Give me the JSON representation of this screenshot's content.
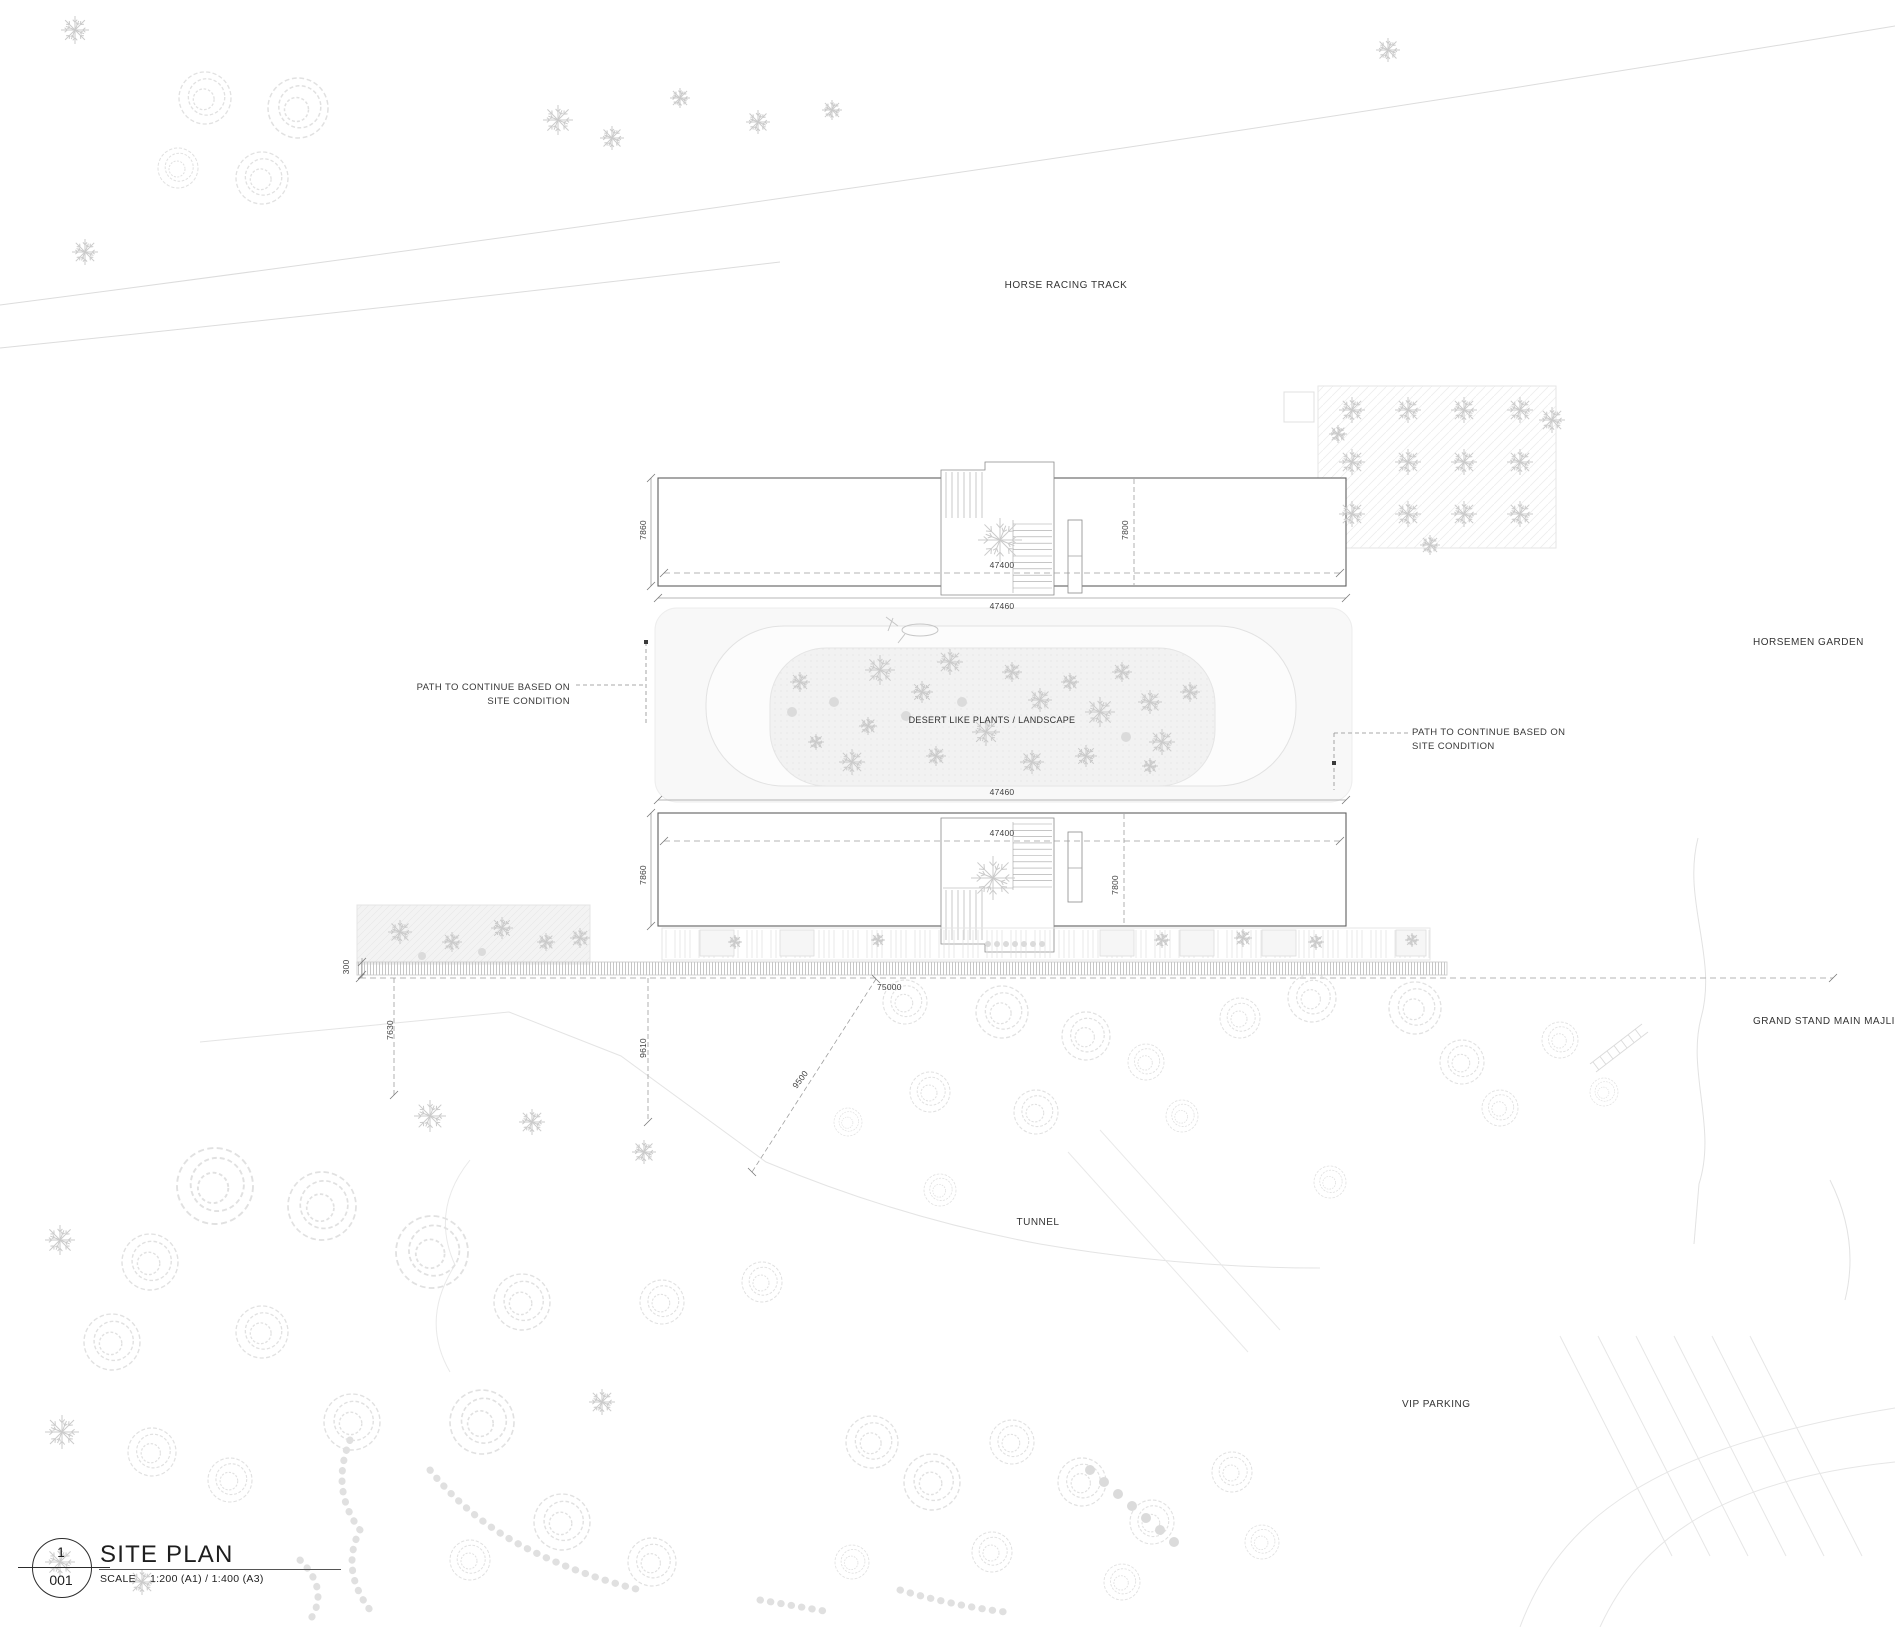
{
  "labels": {
    "horse_racing_track": "HORSE RACING TRACK",
    "horsemen_garden": "HORSEMEN GARDEN",
    "grand_stand_main_majlis": "GRAND STAND MAIN MAJLIS",
    "tunnel": "TUNNEL",
    "vip_parking": "VIP PARKING",
    "desert_plants": "DESERT LIKE PLANTS / LANDSCAPE"
  },
  "annotations": {
    "path_left": {
      "line1": "PATH TO CONTINUE BASED ON",
      "line2": "SITE CONDITION"
    },
    "path_right": {
      "line1": "PATH TO CONTINUE BASED ON",
      "line2": "SITE CONDITION"
    }
  },
  "dims": {
    "width_inner": "47400",
    "width_outer": "47460",
    "depth_left": "7860",
    "depth_right": "7800",
    "walkway": "300",
    "total": "75000",
    "off_left": "7630",
    "off_center": "9610",
    "off_diag": "9500"
  },
  "title_block": {
    "detail_number": "1",
    "sheet_number": "001",
    "title": "SITE PLAN",
    "scale_label": "SCALE",
    "scale_value": "1:200 (A1) / 1:400 (A3)"
  },
  "colors": {
    "line_dark": "#5f5f5f",
    "line_dim": "#9a9a9a",
    "line_faint": "#e0e0e0",
    "fill_band": "#f8f8f8",
    "fill_planted": "#f2f2f2",
    "text": "#3a3a3a"
  },
  "landscape": {
    "trees": [
      [
        75,
        30,
        14,
        "p"
      ],
      [
        205,
        98,
        26,
        "r"
      ],
      [
        298,
        108,
        30,
        "r"
      ],
      [
        262,
        178,
        26,
        "r"
      ],
      [
        178,
        168,
        20,
        "r"
      ],
      [
        85,
        252,
        13,
        "p"
      ],
      [
        558,
        120,
        15,
        "p"
      ],
      [
        612,
        138,
        12,
        "p"
      ],
      [
        680,
        98,
        10,
        "p"
      ],
      [
        758,
        122,
        12,
        "p"
      ],
      [
        832,
        110,
        10,
        "p"
      ],
      [
        1388,
        50,
        12,
        "p"
      ],
      [
        1352,
        410,
        13,
        "p"
      ],
      [
        1408,
        410,
        13,
        "p"
      ],
      [
        1464,
        410,
        13,
        "p"
      ],
      [
        1520,
        410,
        13,
        "p"
      ],
      [
        1352,
        462,
        13,
        "p"
      ],
      [
        1408,
        462,
        13,
        "p"
      ],
      [
        1464,
        462,
        13,
        "p"
      ],
      [
        1520,
        462,
        13,
        "p"
      ],
      [
        1352,
        514,
        13,
        "p"
      ],
      [
        1408,
        514,
        13,
        "p"
      ],
      [
        1464,
        514,
        13,
        "p"
      ],
      [
        1520,
        514,
        13,
        "p"
      ],
      [
        1338,
        434,
        9,
        "p"
      ],
      [
        1552,
        420,
        13,
        "p"
      ],
      [
        1430,
        545,
        10,
        "p"
      ],
      [
        800,
        682,
        10,
        "p"
      ],
      [
        816,
        742,
        8,
        "p"
      ],
      [
        834,
        702,
        5,
        "s"
      ],
      [
        852,
        762,
        13,
        "p"
      ],
      [
        880,
        670,
        15,
        "p"
      ],
      [
        868,
        726,
        9,
        "p"
      ],
      [
        906,
        716,
        5,
        "s"
      ],
      [
        922,
        692,
        11,
        "p"
      ],
      [
        950,
        662,
        13,
        "p"
      ],
      [
        962,
        702,
        5,
        "s"
      ],
      [
        986,
        732,
        14,
        "p"
      ],
      [
        1012,
        672,
        10,
        "p"
      ],
      [
        1040,
        700,
        12,
        "p"
      ],
      [
        1032,
        762,
        12,
        "p"
      ],
      [
        1070,
        682,
        9,
        "p"
      ],
      [
        1100,
        712,
        15,
        "p"
      ],
      [
        1122,
        672,
        10,
        "p"
      ],
      [
        1150,
        702,
        12,
        "p"
      ],
      [
        1162,
        742,
        13,
        "p"
      ],
      [
        1190,
        692,
        10,
        "p"
      ],
      [
        1150,
        766,
        8,
        "p"
      ],
      [
        936,
        756,
        10,
        "p"
      ],
      [
        1086,
        756,
        11,
        "p"
      ],
      [
        792,
        712,
        5,
        "s"
      ],
      [
        1126,
        737,
        5,
        "s"
      ],
      [
        1000,
        540,
        22,
        "p"
      ],
      [
        993,
        878,
        22,
        "p"
      ],
      [
        400,
        932,
        12,
        "p"
      ],
      [
        452,
        942,
        10,
        "p"
      ],
      [
        502,
        928,
        11,
        "p"
      ],
      [
        546,
        942,
        9,
        "p"
      ],
      [
        422,
        956,
        4,
        "s"
      ],
      [
        482,
        952,
        4,
        "s"
      ],
      [
        580,
        938,
        10,
        "p"
      ],
      [
        735,
        942,
        7,
        "p"
      ],
      [
        878,
        940,
        7,
        "p"
      ],
      [
        1162,
        940,
        8,
        "p"
      ],
      [
        1243,
        938,
        9,
        "p"
      ],
      [
        1316,
        942,
        8,
        "p"
      ],
      [
        1412,
        940,
        7,
        "p"
      ],
      [
        988,
        944,
        3,
        "s"
      ],
      [
        997,
        944,
        3,
        "s"
      ],
      [
        1006,
        944,
        3,
        "s"
      ],
      [
        1015,
        944,
        3,
        "s"
      ],
      [
        1024,
        944,
        3,
        "s"
      ],
      [
        1033,
        944,
        3,
        "s"
      ],
      [
        1042,
        944,
        3,
        "s"
      ],
      [
        905,
        1002,
        22,
        "r"
      ],
      [
        1002,
        1012,
        26,
        "r"
      ],
      [
        1086,
        1036,
        24,
        "r"
      ],
      [
        930,
        1092,
        20,
        "r"
      ],
      [
        1036,
        1112,
        22,
        "r"
      ],
      [
        1146,
        1062,
        18,
        "r"
      ],
      [
        1240,
        1018,
        20,
        "r"
      ],
      [
        1312,
        998,
        24,
        "r"
      ],
      [
        1415,
        1008,
        26,
        "r"
      ],
      [
        1462,
        1062,
        22,
        "r"
      ],
      [
        1500,
        1108,
        18,
        "r"
      ],
      [
        1182,
        1116,
        16,
        "r"
      ],
      [
        1560,
        1040,
        18,
        "r"
      ],
      [
        1604,
        1092,
        14,
        "r"
      ],
      [
        430,
        1116,
        16,
        "p"
      ],
      [
        532,
        1122,
        13,
        "p"
      ],
      [
        644,
        1152,
        12,
        "p"
      ],
      [
        848,
        1122,
        14,
        "r"
      ],
      [
        940,
        1190,
        16,
        "r"
      ],
      [
        1330,
        1182,
        16,
        "r"
      ],
      [
        215,
        1186,
        38,
        "r"
      ],
      [
        322,
        1206,
        34,
        "r"
      ],
      [
        150,
        1262,
        28,
        "r"
      ],
      [
        60,
        1240,
        15,
        "p"
      ],
      [
        112,
        1342,
        28,
        "r"
      ],
      [
        262,
        1332,
        26,
        "r"
      ],
      [
        432,
        1252,
        36,
        "r"
      ],
      [
        522,
        1302,
        28,
        "r"
      ],
      [
        62,
        1432,
        17,
        "p"
      ],
      [
        152,
        1452,
        24,
        "r"
      ],
      [
        352,
        1422,
        28,
        "r"
      ],
      [
        482,
        1422,
        32,
        "r"
      ],
      [
        602,
        1402,
        13,
        "p"
      ],
      [
        662,
        1302,
        22,
        "r"
      ],
      [
        762,
        1282,
        20,
        "r"
      ],
      [
        562,
        1522,
        28,
        "r"
      ],
      [
        652,
        1562,
        24,
        "r"
      ],
      [
        60,
        1562,
        15,
        "p"
      ],
      [
        142,
        1582,
        13,
        "p"
      ],
      [
        470,
        1560,
        20,
        "r"
      ],
      [
        230,
        1480,
        22,
        "r"
      ],
      [
        872,
        1442,
        26,
        "r"
      ],
      [
        932,
        1482,
        28,
        "r"
      ],
      [
        1012,
        1442,
        22,
        "r"
      ],
      [
        1082,
        1482,
        24,
        "r"
      ],
      [
        1152,
        1522,
        22,
        "r"
      ],
      [
        992,
        1552,
        20,
        "r"
      ],
      [
        1122,
        1582,
        18,
        "r"
      ],
      [
        852,
        1562,
        17,
        "r"
      ],
      [
        1232,
        1472,
        20,
        "r"
      ],
      [
        1262,
        1542,
        17,
        "r"
      ],
      [
        1090,
        1470,
        5,
        "s"
      ],
      [
        1104,
        1482,
        5,
        "s"
      ],
      [
        1118,
        1494,
        5,
        "s"
      ],
      [
        1132,
        1506,
        5,
        "s"
      ],
      [
        1146,
        1518,
        5,
        "s"
      ],
      [
        1160,
        1530,
        5,
        "s"
      ],
      [
        1174,
        1542,
        5,
        "s"
      ]
    ]
  }
}
